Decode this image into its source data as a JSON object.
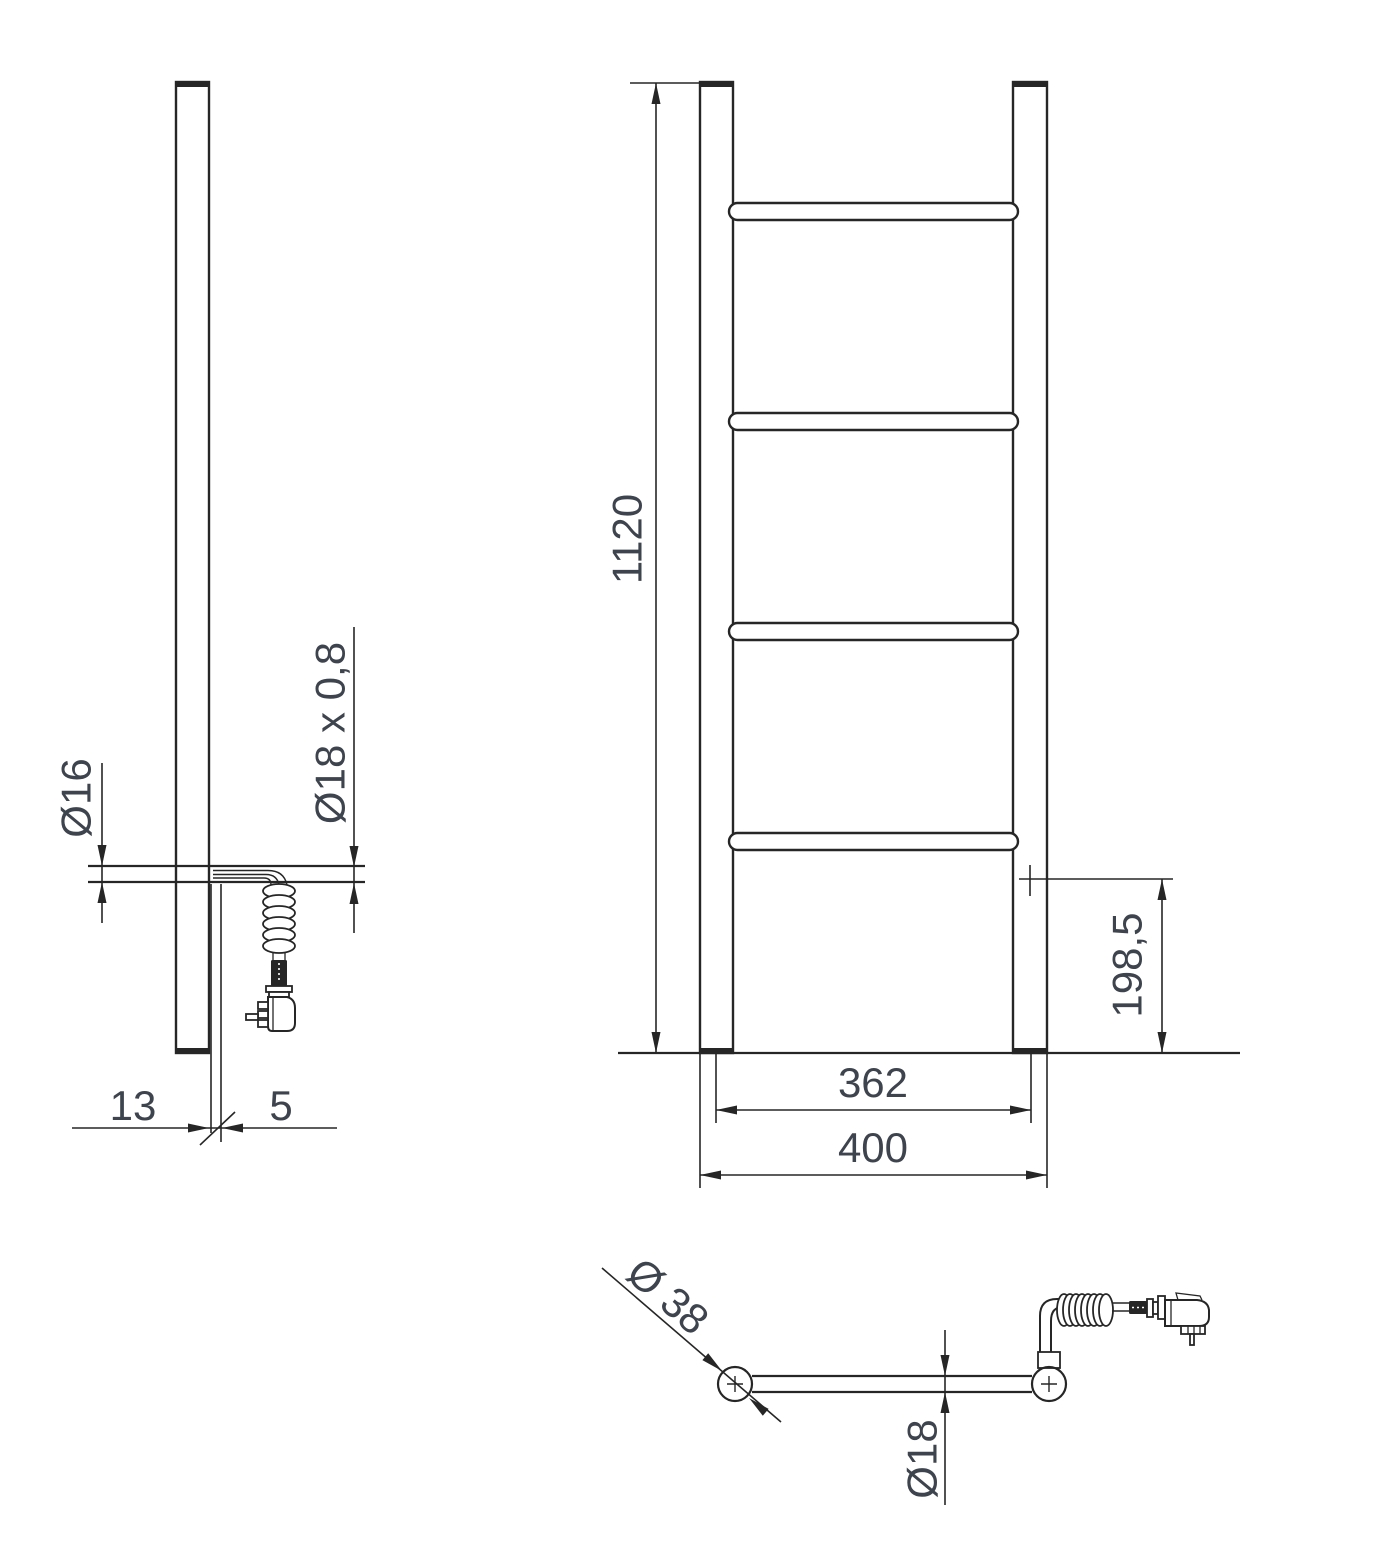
{
  "colors": {
    "background": "#ffffff",
    "line": "#262626",
    "dimension_text": "#3e444d"
  },
  "views": {
    "side": {
      "dims": {
        "element_diameter": "Ø16",
        "tube_spec": "Ø18 x 0,8",
        "wall_offset": "13",
        "bracket_thickness": "5"
      }
    },
    "front": {
      "dims": {
        "overall_height": "1120",
        "element_offset": "198,5",
        "tube_centers_width": "362",
        "overall_width": "400"
      }
    },
    "top": {
      "dims": {
        "vertical_tube_diameter": "Ø 38",
        "crossbar_diameter": "Ø18"
      }
    }
  }
}
